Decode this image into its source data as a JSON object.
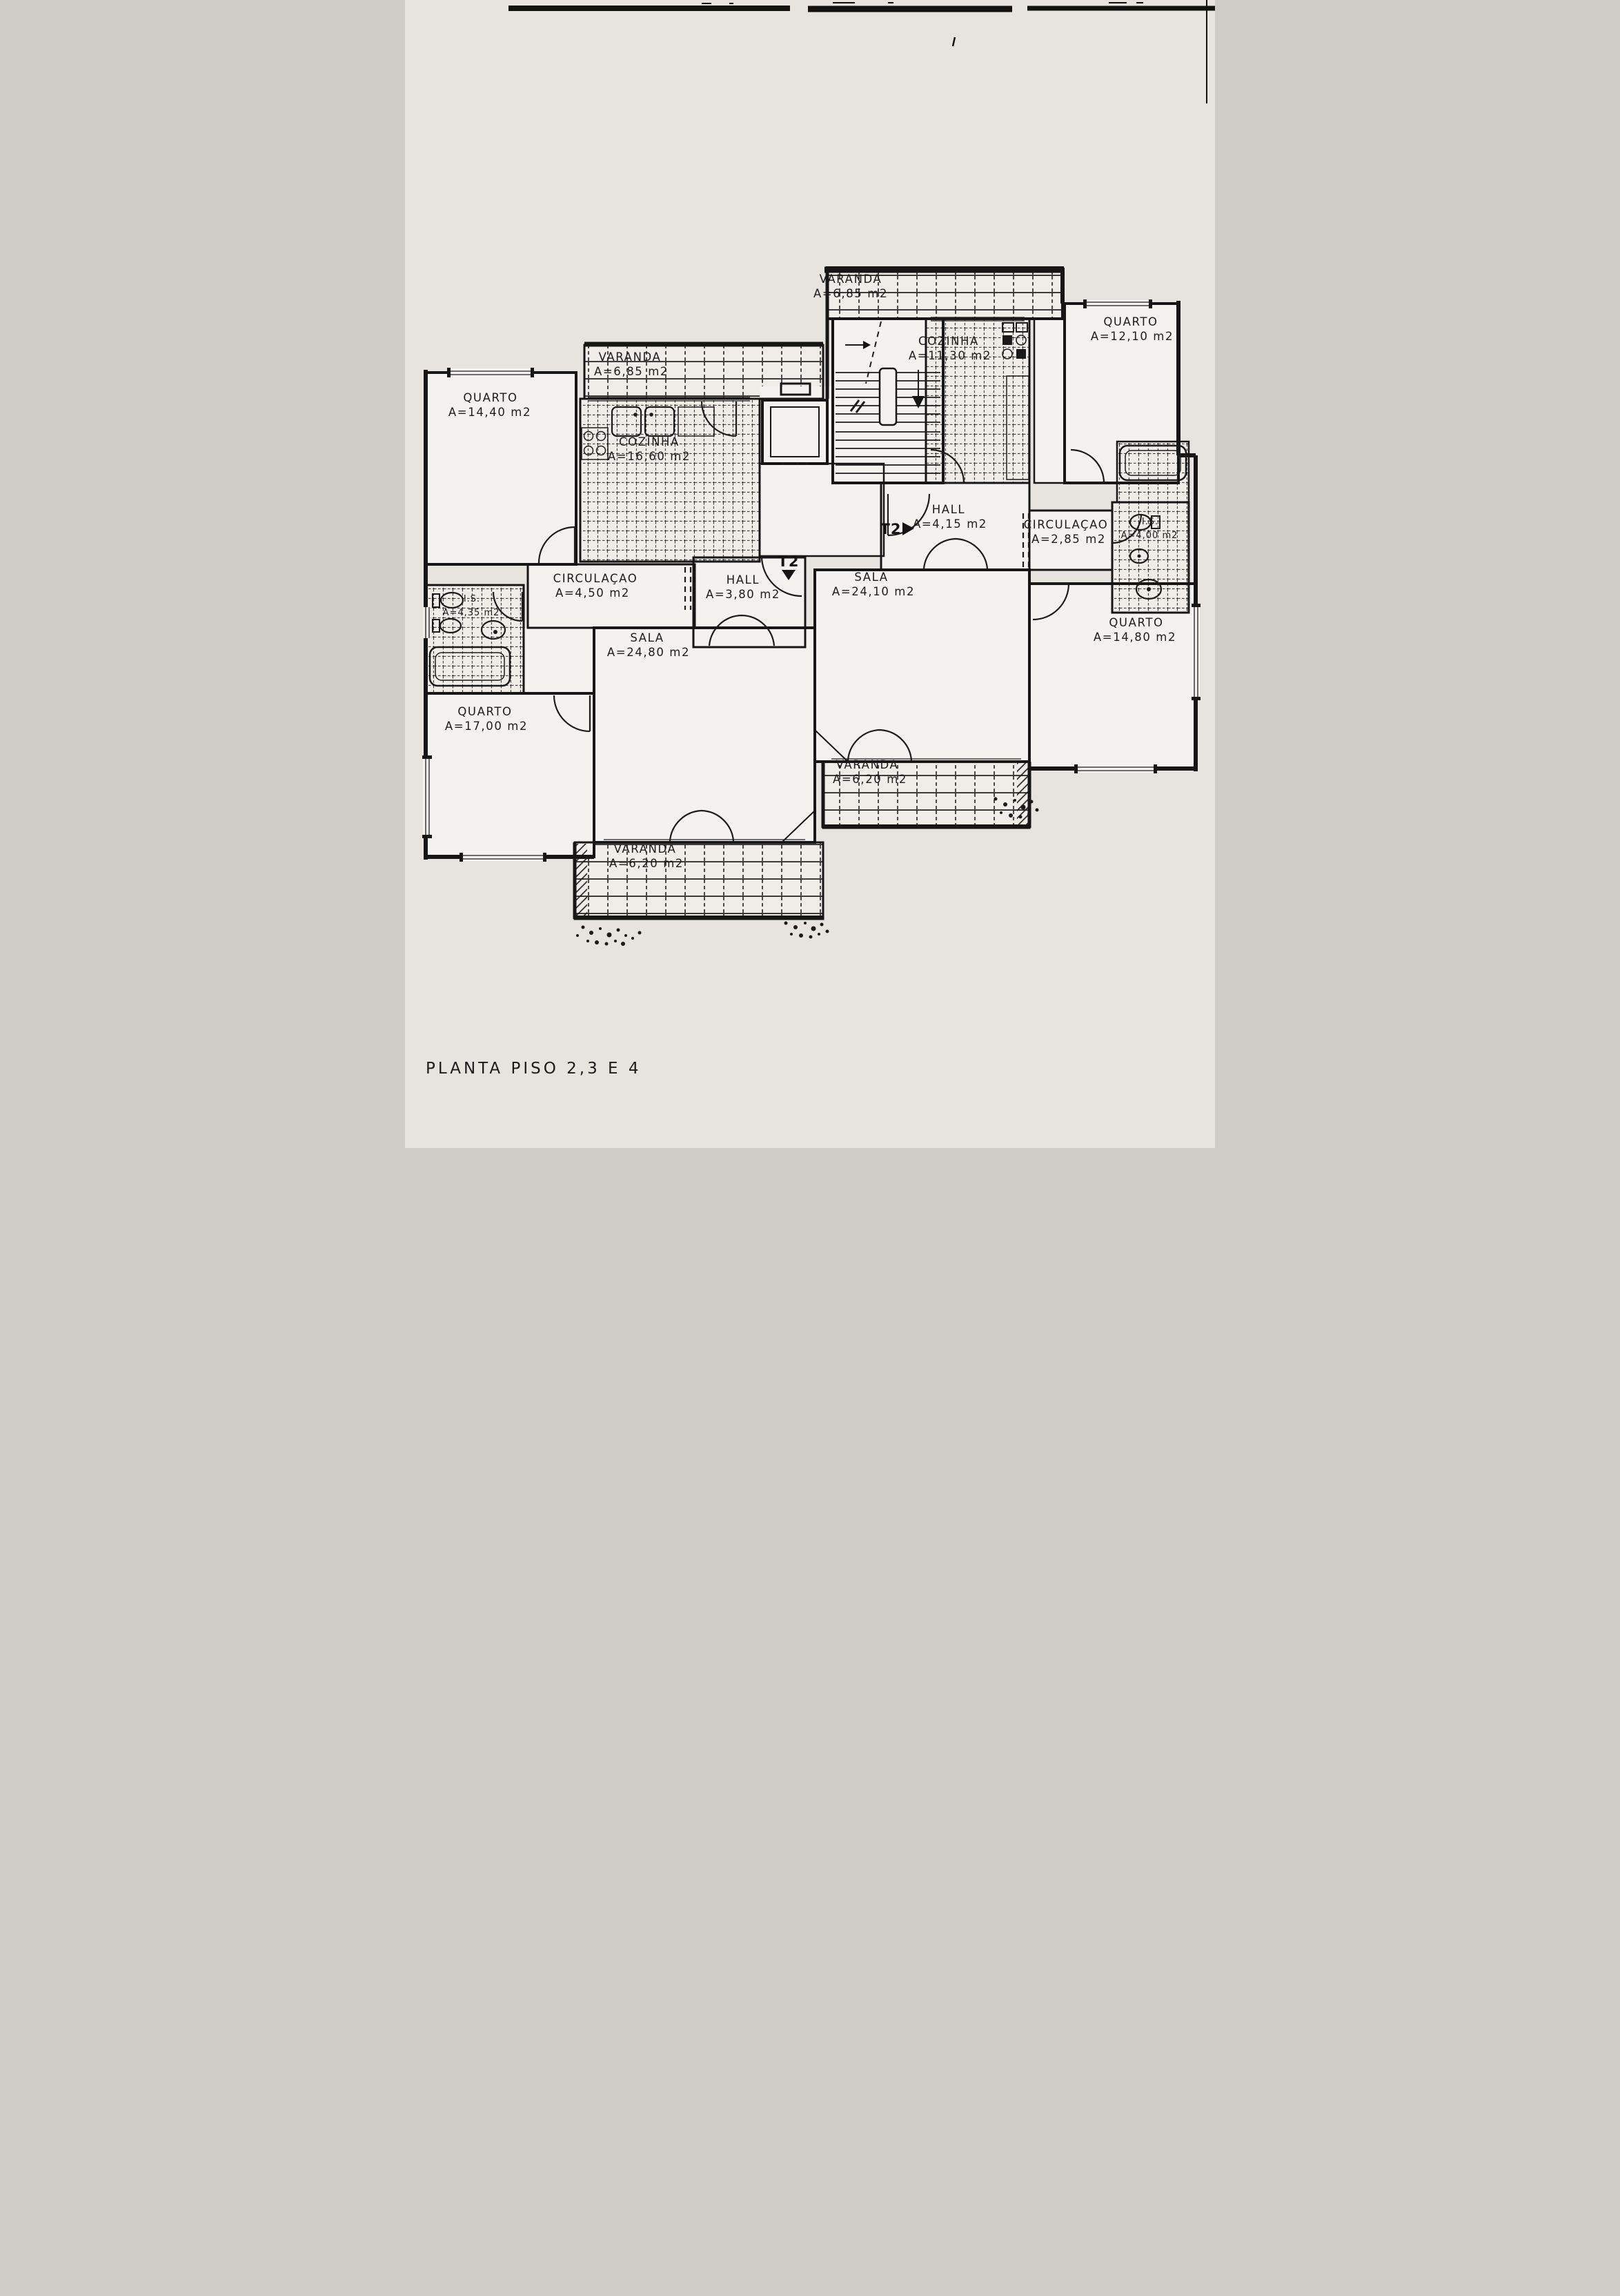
{
  "document": {
    "title": "PLANTA PISO 2,3 E 4"
  },
  "markers": {
    "left_unit": "T2",
    "right_unit": "T2"
  },
  "rooms": [
    {
      "id": "varanda-top",
      "name": "VARANDA",
      "area": "A=6,85 m2"
    },
    {
      "id": "cozinha-right",
      "name": "COZINHA",
      "area": "A=11,30 m2"
    },
    {
      "id": "quarto-top-right",
      "name": "QUARTO",
      "area": "A=12,10 m2"
    },
    {
      "id": "varanda-left",
      "name": "VARANDA",
      "area": "A=6,85 m2"
    },
    {
      "id": "quarto-top-left",
      "name": "QUARTO",
      "area": "A=14,40 m2"
    },
    {
      "id": "cozinha-left",
      "name": "COZINHA",
      "area": "A=16,60 m2"
    },
    {
      "id": "hall-right",
      "name": "HALL",
      "area": "A=4,15 m2"
    },
    {
      "id": "circulacao-right",
      "name": "CIRCULAÇAO",
      "area": "A=2,85 m2"
    },
    {
      "id": "is-right",
      "name": "I.S.",
      "area": "A=4,00 m2"
    },
    {
      "id": "circulacao-left",
      "name": "CIRCULAÇAO",
      "area": "A=4,50 m2"
    },
    {
      "id": "hall-left",
      "name": "HALL",
      "area": "A=3,80 m2"
    },
    {
      "id": "sala-right",
      "name": "SALA",
      "area": "A=24,10 m2"
    },
    {
      "id": "is-left",
      "name": "I.S.",
      "area": "A=4,35 m2"
    },
    {
      "id": "sala-left",
      "name": "SALA",
      "area": "A=24,80 m2"
    },
    {
      "id": "quarto-right",
      "name": "QUARTO",
      "area": "A=14,80 m2"
    },
    {
      "id": "quarto-bottom-left",
      "name": "QUARTO",
      "area": "A=17,00 m2"
    },
    {
      "id": "varanda-mid",
      "name": "VARANDA",
      "area": "A=6,20 m2"
    },
    {
      "id": "varanda-bottom",
      "name": "VARANDA",
      "area": "A=6,20 m2"
    }
  ]
}
